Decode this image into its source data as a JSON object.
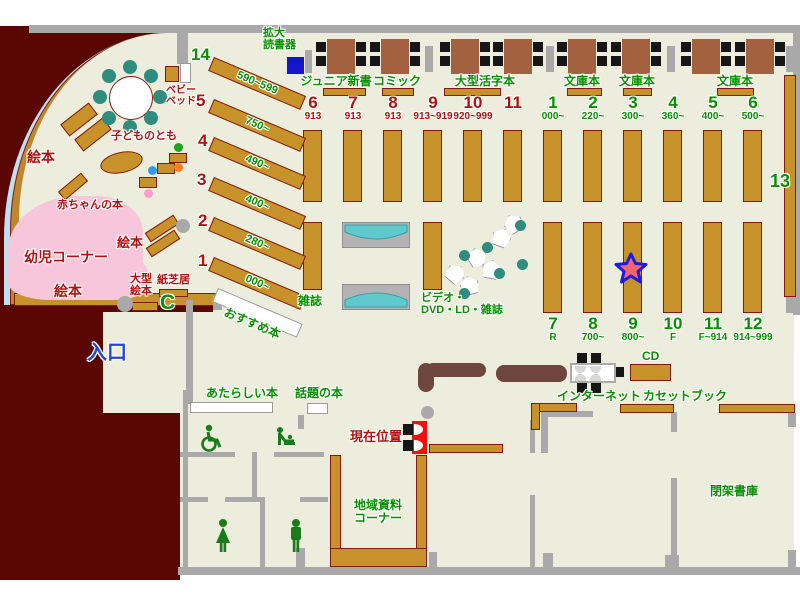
{
  "colors": {
    "outside": "#5A0704",
    "floor": "#ECEDDC",
    "wall": "#A9A9A9",
    "shelf": "#C8922B",
    "shelf_border": "#86180E",
    "table": "#A4613F",
    "chair_black": "#161616",
    "seat_teal": "#2F8C7E",
    "rack_cyan": "#5FC9CB",
    "infant_pink": "#F7C6DA",
    "green_text": "#089000",
    "red_text": "#B01111",
    "entrance_blue": "#2244DD",
    "marker_red": "#EE1111",
    "sofa": "#6E463E",
    "star_fill": "#F4646E",
    "star_stroke": "#1C1CE8",
    "magnifier_blue": "#1515CC"
  },
  "top_section": {
    "magnifier_label": "拡大\n読書器",
    "categories": [
      {
        "label": "ジュニア新書"
      },
      {
        "label": "コミック"
      },
      {
        "label": "大型活字本"
      },
      {
        "label": "文庫本"
      },
      {
        "label": "文庫本"
      },
      {
        "label": "文庫本"
      }
    ],
    "columns": [
      {
        "num": "6",
        "range": "913",
        "color": "red"
      },
      {
        "num": "7",
        "range": "913",
        "color": "red"
      },
      {
        "num": "8",
        "range": "913",
        "color": "red"
      },
      {
        "num": "9",
        "range": "913~919",
        "color": "red"
      },
      {
        "num": "10",
        "range": "920~999",
        "color": "red"
      },
      {
        "num": "11",
        "range": "",
        "color": "red"
      },
      {
        "num": "1",
        "range": "000~",
        "color": "green"
      },
      {
        "num": "2",
        "range": "220~",
        "color": "green"
      },
      {
        "num": "3",
        "range": "300~",
        "color": "green"
      },
      {
        "num": "4",
        "range": "360~",
        "color": "green"
      },
      {
        "num": "5",
        "range": "400~",
        "color": "green"
      },
      {
        "num": "6",
        "range": "500~",
        "color": "green"
      }
    ]
  },
  "bottom_shelves": {
    "magazine_label": "雑誌",
    "av_label": "ビデオ・\nDVD・LD・雑誌",
    "columns": [
      {
        "num": "7",
        "range": "R"
      },
      {
        "num": "8",
        "range": "700~"
      },
      {
        "num": "9",
        "range": "800~"
      },
      {
        "num": "10",
        "range": "F"
      },
      {
        "num": "11",
        "range": "F~914"
      },
      {
        "num": "12",
        "range": "914~999"
      }
    ],
    "wall_shelf_num": "13"
  },
  "children_corner": {
    "diagonal_shelves": [
      {
        "num": "14",
        "num_color": "green",
        "range": "590~599"
      },
      {
        "num": "5",
        "num_color": "red",
        "range": "750~"
      },
      {
        "num": "4",
        "num_color": "red",
        "range": "490~"
      },
      {
        "num": "3",
        "num_color": "red",
        "range": "400~"
      },
      {
        "num": "2",
        "num_color": "red",
        "range": "280~"
      },
      {
        "num": "1",
        "num_color": "red",
        "range": "000~"
      }
    ],
    "recommended_label": "おすすめ本",
    "baby_bed_label": "ベビー\nベッド",
    "kodomo_label": "子どものとも",
    "baby_books_label": "赤ちゃんの本",
    "infant_corner_label": "幼児コーナー",
    "picture_book_labels": [
      "絵本",
      "絵本",
      "絵本"
    ],
    "large_picture_label": "大型\n絵本",
    "kamishibai_label": "紙芝居",
    "c_mark": "C"
  },
  "entrance_label": "入口",
  "lower_section": {
    "new_books_label": "あたらしい本",
    "topic_books_label": "話題の本",
    "current_position_label": "現在位置",
    "internet_label": "インターネット",
    "cd_label": "CD",
    "cassette_label": "カセットブック",
    "closed_stacks_label": "閉架書庫",
    "local_materials_label": "地域資料\nコーナー"
  }
}
